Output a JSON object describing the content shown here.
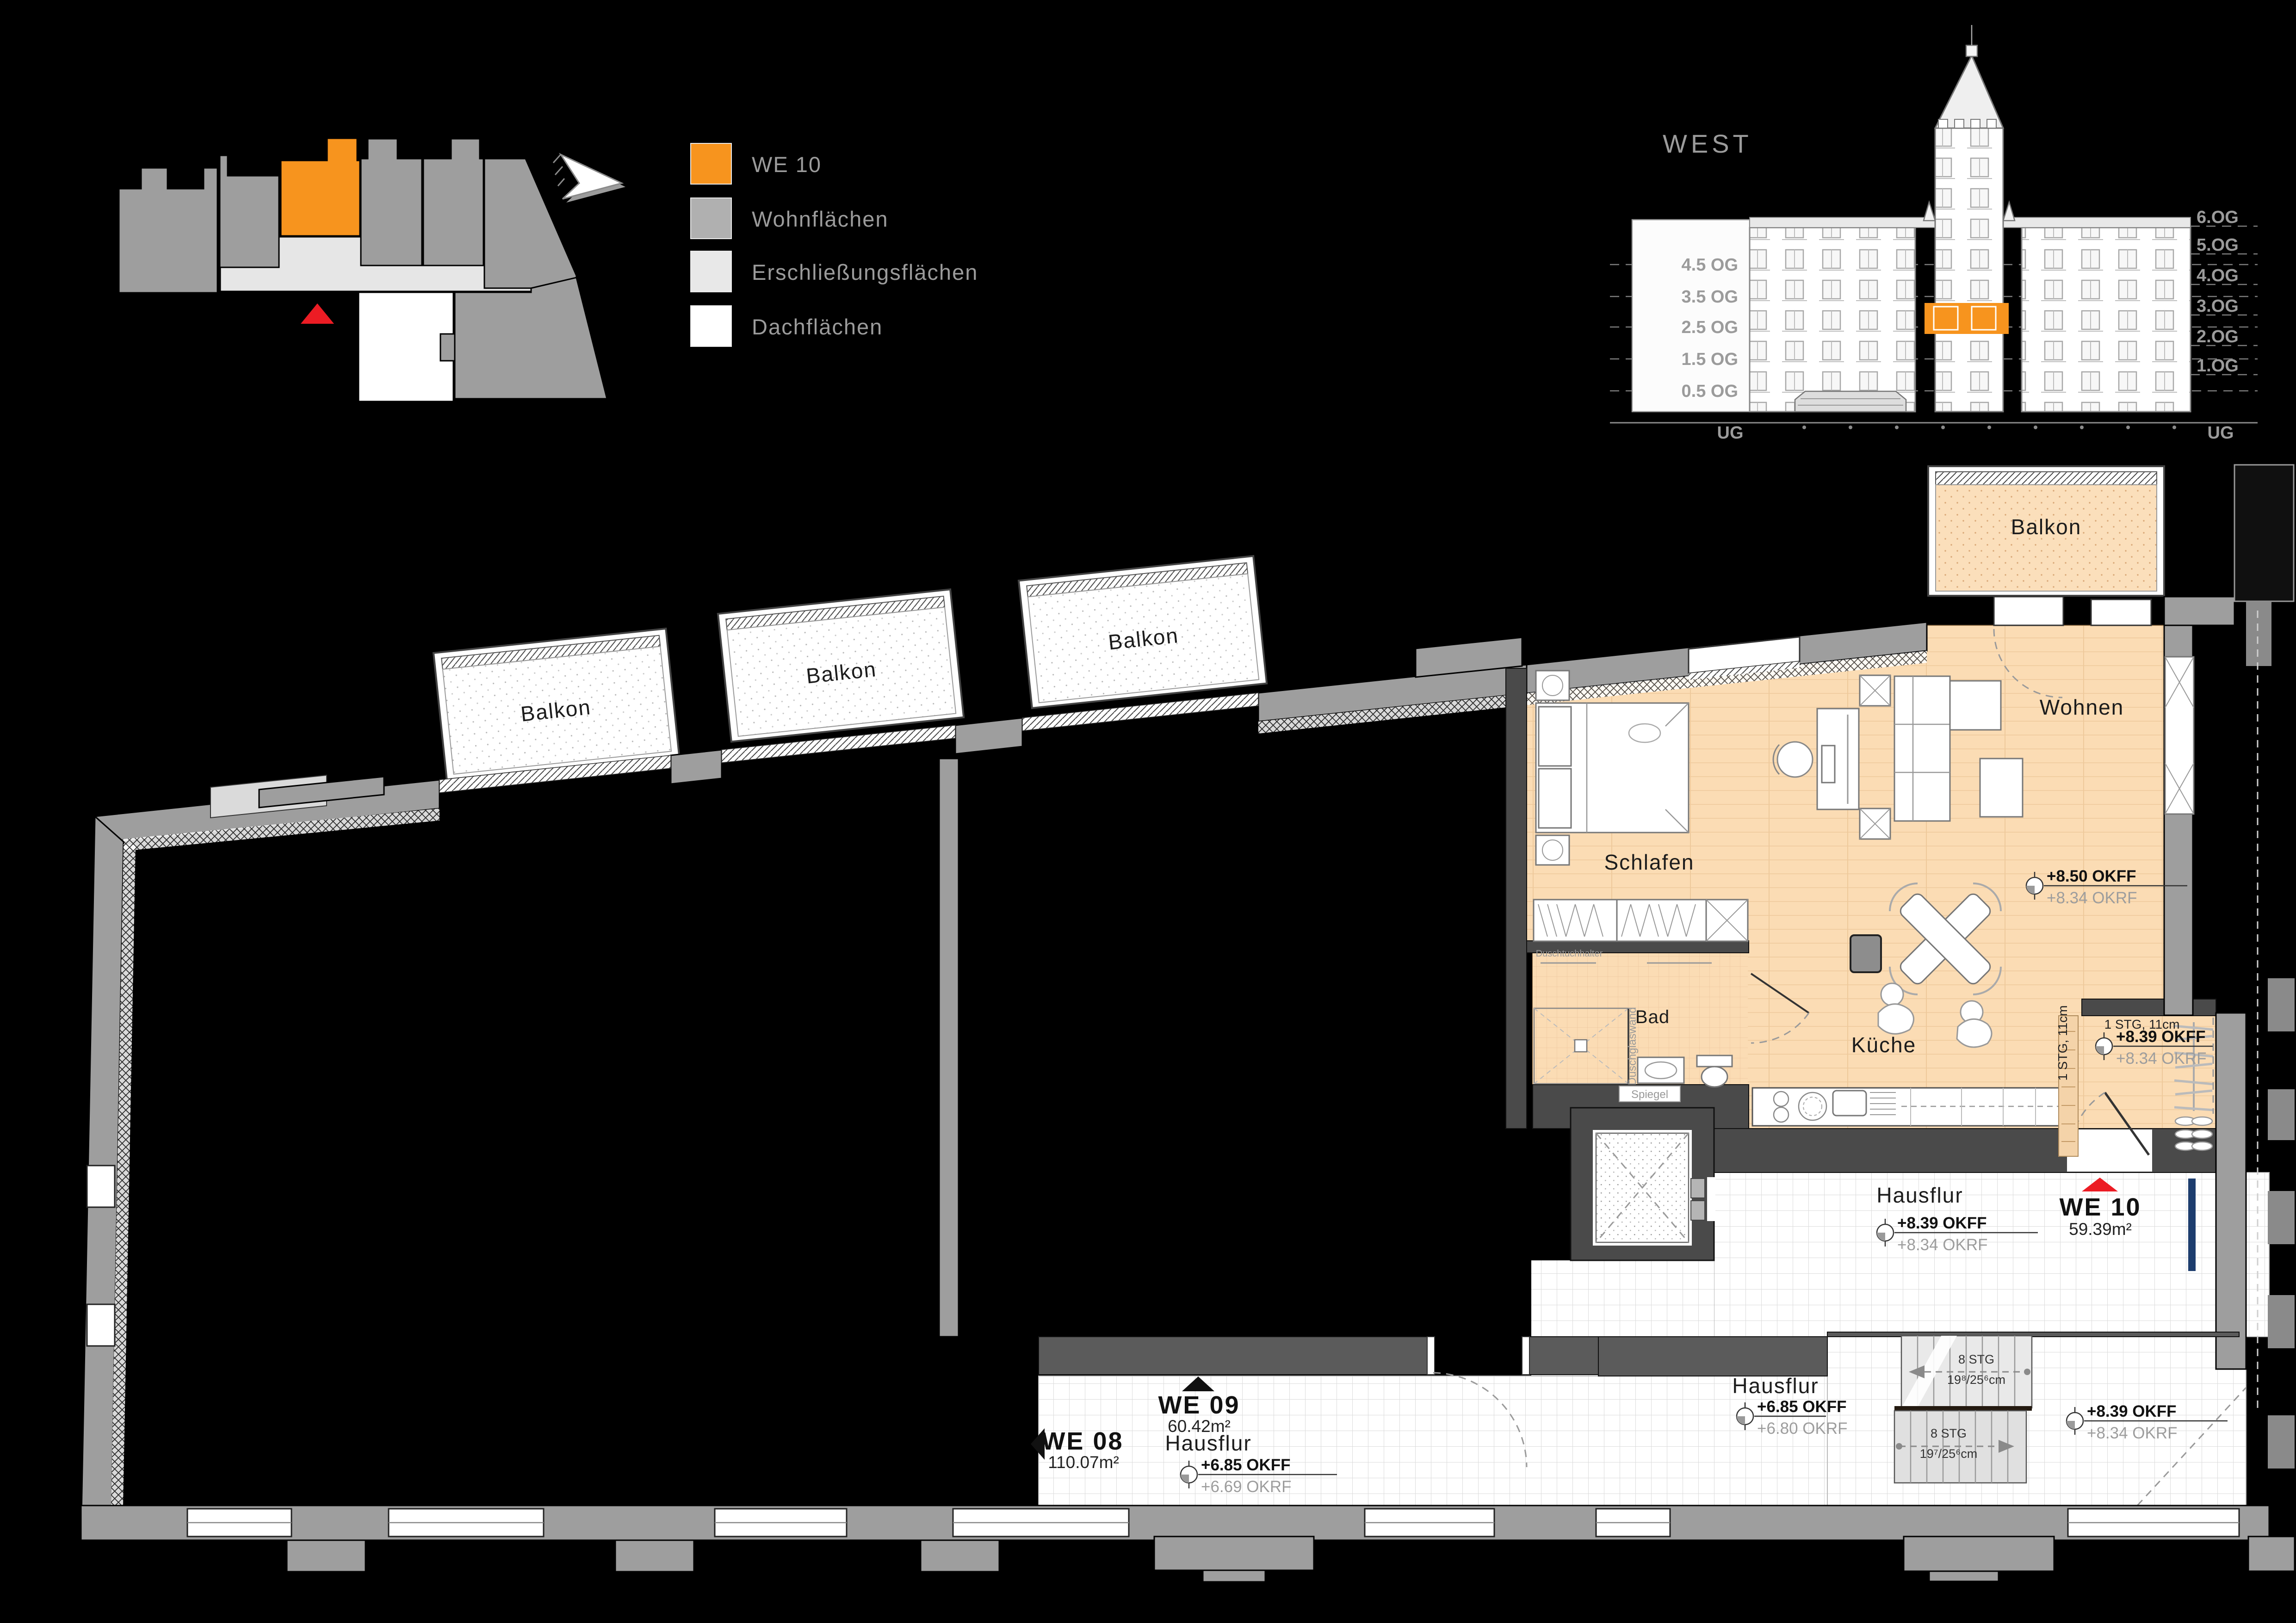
{
  "colors": {
    "highlight_orange": "#F7941E",
    "wohnflaechen_gray": "#B0B0B0",
    "erschliessung_gray": "#E8E8E8",
    "dach_white": "#FFFFFF",
    "apartment_floor": "#FBDCB4",
    "marker_red": "#EC1C24",
    "corridor_tile": "#FFFFFF"
  },
  "legend": {
    "items": [
      {
        "label": "WE 10",
        "color": "#F7941E"
      },
      {
        "label": "Wohnflächen",
        "color": "#B0B0B0"
      },
      {
        "label": "Erschließungsflächen",
        "color": "#E8E8E8"
      },
      {
        "label": "Dachflächen",
        "color": "#FFFFFF"
      }
    ]
  },
  "elevation": {
    "title": "WEST",
    "left_levels": [
      "4.5 OG",
      "3.5 OG",
      "2.5 OG",
      "1.5 OG",
      "0.5 OG"
    ],
    "left_base": "UG",
    "right_levels": [
      "6.OG",
      "5.OG",
      "4.OG",
      "3.OG",
      "2.OG",
      "1.OG"
    ],
    "right_base": "UG"
  },
  "floor_plan": {
    "balconies": [
      "Balkon",
      "Balkon",
      "Balkon",
      "Balkon"
    ],
    "rooms": {
      "schlafen": "Schlafen",
      "wohnen": "Wohnen",
      "bad": "Bad",
      "kueche": "Küche"
    },
    "corridors": {
      "right": "Hausflur",
      "mid": "Hausflur",
      "left": "Hausflur"
    },
    "units": {
      "we10": {
        "id": "WE 10",
        "area": "59.39m²"
      },
      "we09": {
        "id": "WE 09",
        "area": "60.42m²"
      },
      "we08": {
        "id": "WE 08",
        "area": "110.07m²"
      }
    },
    "markers": [
      {
        "top": "+8.50 OKFF",
        "bottom": "+8.34 OKRF"
      },
      {
        "top": "+8.39 OKFF",
        "bottom": "+8.34 OKRF"
      },
      {
        "top": "+8.39 OKFF",
        "bottom": "+8.34 OKRF"
      },
      {
        "top": "+6.85 OKFF",
        "bottom": "+6.69 OKRF"
      },
      {
        "top": "+6.85 OKFF",
        "bottom": "+6.80 OKRF"
      },
      {
        "top": "+8.39 OKFF",
        "bottom": "+8.34 OKRF"
      }
    ],
    "stairs": [
      {
        "line1": "8 STG",
        "line2": "19⁸/25⁶cm"
      },
      {
        "line1": "8 STG",
        "line2": "19⁷/25⁶cm"
      }
    ],
    "steps": [
      {
        "label": "1 STG, 11cm"
      },
      {
        "label": "1 STG, 11cm"
      }
    ],
    "small_labels": {
      "spiegel": "Spiegel",
      "duschglaswand": "Duschglaswand",
      "duschtuchhalter": "Duschtuchhalter"
    }
  }
}
